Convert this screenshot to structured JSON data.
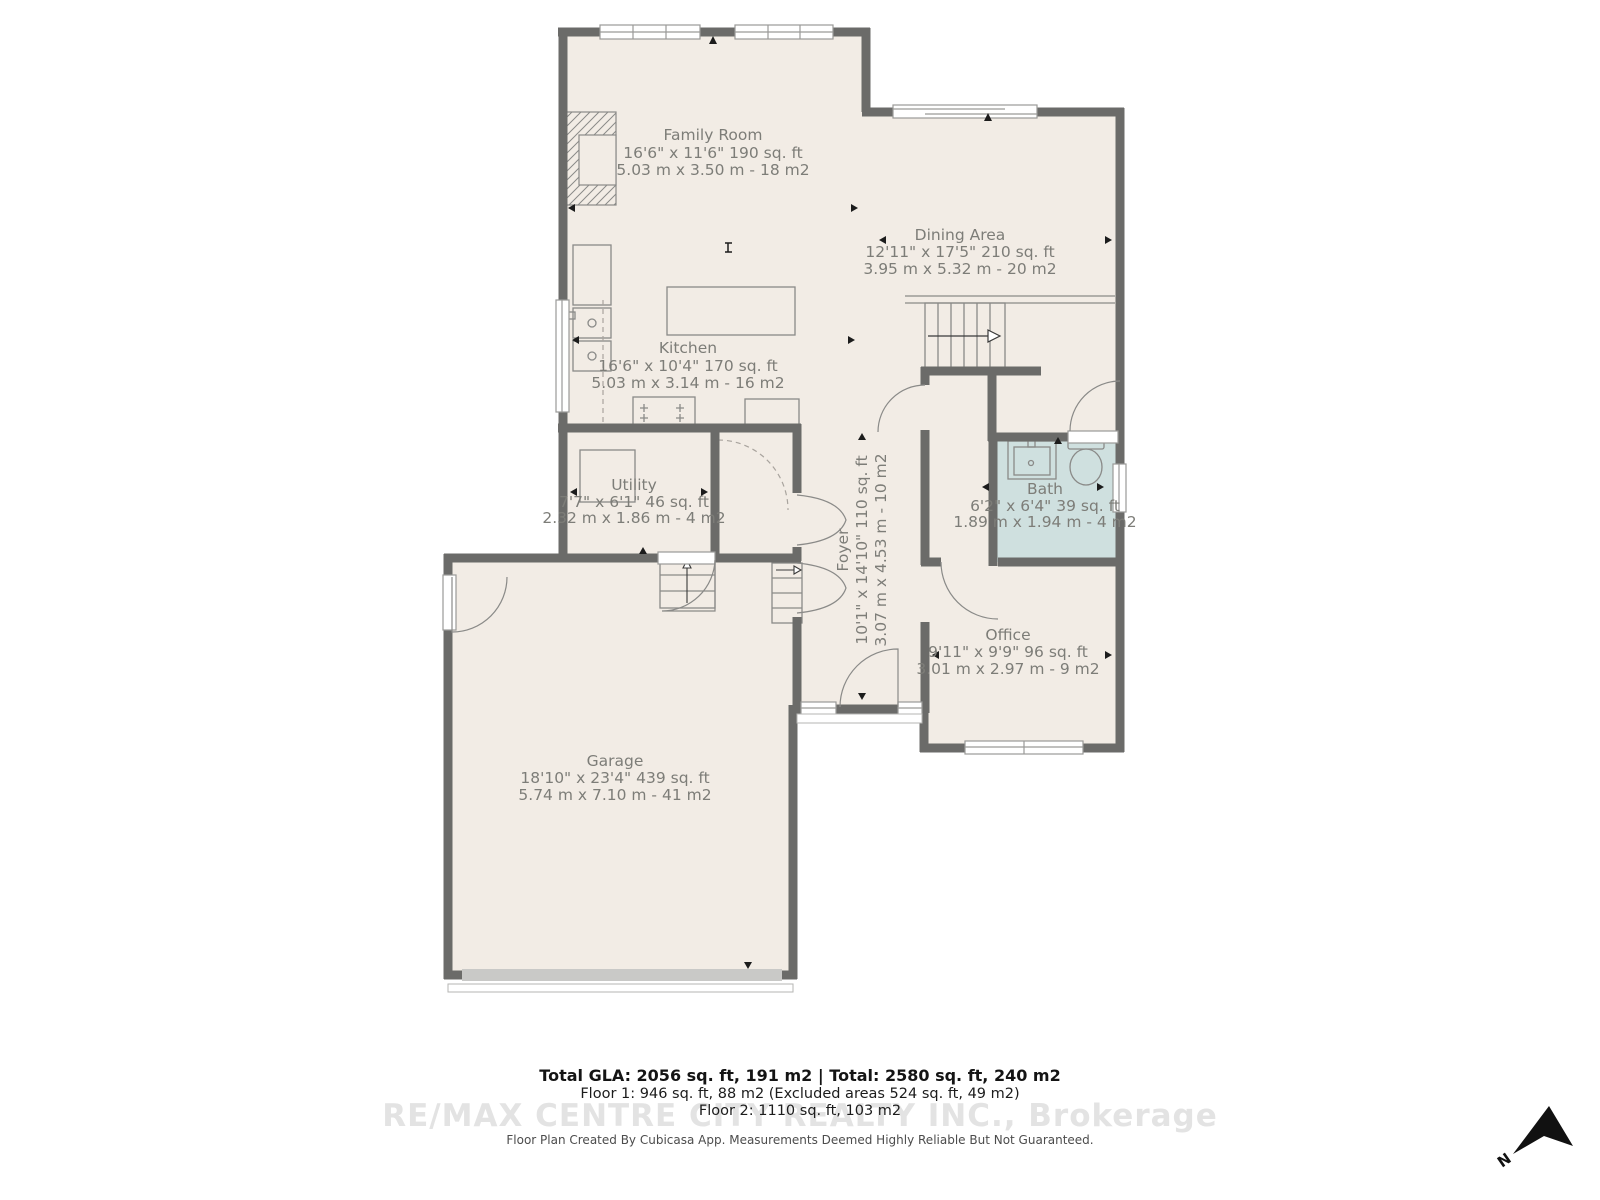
{
  "rooms": {
    "family_room": {
      "name": "Family Room",
      "imperial": "16'6\" x 11'6\" 190 sq. ft",
      "metric": "5.03 m x 3.50 m - 18 m2"
    },
    "dining_area": {
      "name": "Dining Area",
      "imperial": "12'11\" x 17'5\" 210 sq. ft",
      "metric": "3.95 m x 5.32 m - 20 m2"
    },
    "kitchen": {
      "name": "Kitchen",
      "imperial": "16'6\" x 10'4\" 170 sq. ft",
      "metric": "5.03 m x 3.14 m - 16 m2"
    },
    "utility": {
      "name": "Utility",
      "imperial": "7'7\" x 6'1\" 46 sq. ft",
      "metric": "2.32 m x 1.86 m - 4 m2"
    },
    "bath": {
      "name": "Bath",
      "imperial": "6'2\" x 6'4\" 39 sq. ft",
      "metric": "1.89 m x 1.94 m - 4 m2"
    },
    "foyer": {
      "name": "Foyer",
      "imperial": "10'1\" x 14'10\" 110 sq. ft",
      "metric": "3.07 m x 4.53 m - 10 m2"
    },
    "office": {
      "name": "Office",
      "imperial": "9'11\" x 9'9\" 96 sq. ft",
      "metric": "3.01 m x 2.97 m - 9 m2"
    },
    "garage": {
      "name": "Garage",
      "imperial": "18'10\" x 23'4\" 439 sq. ft",
      "metric": "5.74 m x 7.10 m - 41 m2"
    }
  },
  "footer": {
    "total": "Total GLA: 2056 sq. ft, 191 m2 | Total: 2580 sq. ft, 240 m2",
    "floor1": "Floor 1: 946 sq. ft, 88 m2 (Excluded areas 524 sq. ft, 49 m2)",
    "floor2": "Floor 2: 1110 sq. ft, 103 m2",
    "watermark": "RE/MAX CENTRE CITY REALTY INC., Brokerage",
    "disclaimer": "Floor Plan Created By Cubicasa App. Measurements Deemed Highly Reliable But Not Guaranteed."
  },
  "compass": {
    "label": "N"
  },
  "colors": {
    "wall": "#6b6b69",
    "floor": "#f2ece5",
    "bath_floor": "#cfe0df",
    "label_text": "#7d7d78"
  }
}
